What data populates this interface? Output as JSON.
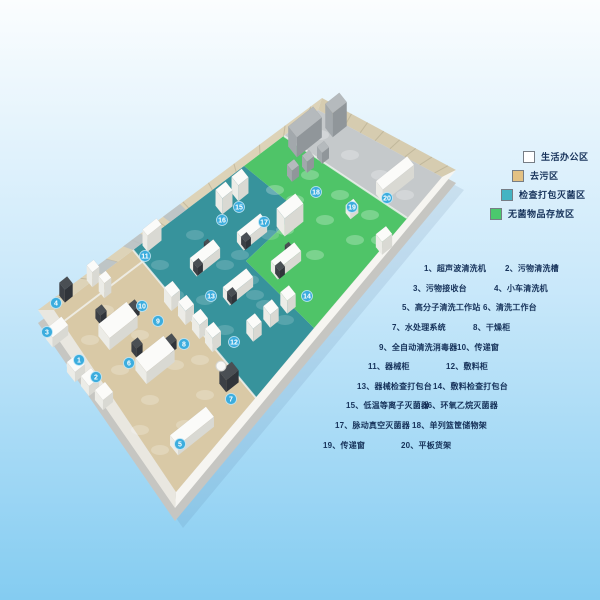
{
  "page": {
    "background_top": "#fbfdfe",
    "background_mid": "#c9e8fa",
    "background_bottom": "#84ccf1",
    "text_color": "#16325a"
  },
  "legend": {
    "items": [
      {
        "label": "生活办公区",
        "color": "#ffffff"
      },
      {
        "label": "去污区",
        "color": "#e3c183"
      },
      {
        "label": "检查打包灭菌区",
        "color": "#44b4c3"
      },
      {
        "label": "无菌物品存放区",
        "color": "#4bc86d"
      }
    ]
  },
  "equipment_list": {
    "separator": "、",
    "items": [
      {
        "num": "1",
        "name": "超声波清洗机"
      },
      {
        "num": "2",
        "name": "污物清洗槽"
      },
      {
        "num": "3",
        "name": "污物接收台"
      },
      {
        "num": "4",
        "name": "小车清洗机"
      },
      {
        "num": "5",
        "name": "高分子清洗工作站"
      },
      {
        "num": "6",
        "name": "清洗工作台"
      },
      {
        "num": "7",
        "name": "水处理系统"
      },
      {
        "num": "8",
        "name": "干燥柜"
      },
      {
        "num": "9",
        "name": "全自动清洗消毒器"
      },
      {
        "num": "10",
        "name": "传递窗"
      },
      {
        "num": "11",
        "name": "器械柜"
      },
      {
        "num": "12",
        "name": "敷料柜"
      },
      {
        "num": "13",
        "name": "器械检查打包台"
      },
      {
        "num": "14",
        "name": "敷料检查打包台"
      },
      {
        "num": "15",
        "name": "低温等离子灭菌器"
      },
      {
        "num": "16",
        "name": "环氧乙烷灭菌器"
      },
      {
        "num": "17",
        "name": "脉动真空灭菌器"
      },
      {
        "num": "18",
        "name": "单列篮筐储物架"
      },
      {
        "num": "19",
        "name": "传递窗"
      },
      {
        "num": "20",
        "name": "平板货架"
      }
    ]
  },
  "floorplan": {
    "marker_color": "#3cadde",
    "marker_ring": "#bfe6f7",
    "zone_colors": {
      "decontamination": "#d9c9a6",
      "inspection_packing_sterilization": "#37939c",
      "sterile_storage": "#4fc468",
      "machine_room": "#c5c9cb",
      "floor_base": "#f1f0ea",
      "wall_top_left": "#ddd3b8",
      "wall_top_right": "#d6ccb0",
      "wall_bottom_right": "#f6f5f1",
      "wall_bottom_left": "#e9e7e0",
      "plinth": "#c6c6c2"
    }
  }
}
